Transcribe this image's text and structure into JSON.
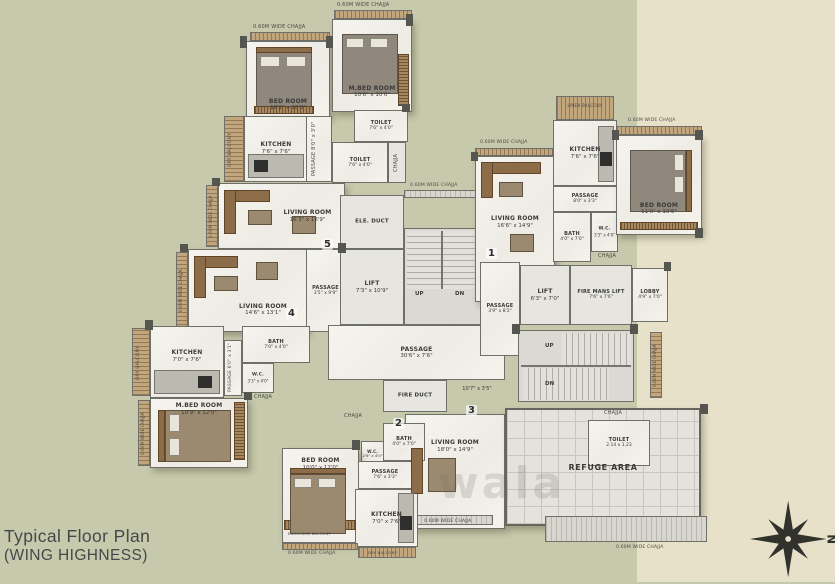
{
  "title": {
    "line1": "Typical Floor Plan",
    "line2": "(WING HIGHNESS)"
  },
  "compass": {
    "label": "N"
  },
  "watermark": "wala",
  "annotations": {
    "chajja_wide": "0.60M WIDE CHAJJA",
    "chajja": "CHAJJA",
    "dry_balcony": "DRY BALCONY",
    "linen_balcony": "LINEN BALCONY",
    "enclosed_balcony": "ENCLOSED BALCONY",
    "up": "UP",
    "dn": "DN"
  },
  "flats": {
    "f1": "1",
    "f2": "2",
    "f3": "3",
    "f4": "4",
    "f5": "5"
  },
  "rooms": {
    "bed6a": {
      "name": "BED ROOM",
      "dims": "10'2\" x 10'0\""
    },
    "mbed6": {
      "name": "M.BED ROOM",
      "dims": "10'6\" x 10'0\""
    },
    "kitchen6": {
      "name": "KITCHEN",
      "dims": "7'6\" x 7'6\""
    },
    "passage6": {
      "name": "PASSAGE",
      "dims": "8'0\" x 3'0\""
    },
    "toilet6a": {
      "name": "TOILET",
      "dims": "7'6\" x 4'0\""
    },
    "toilet6b": {
      "name": "TOILET",
      "dims": "7'6\" x 4'0\""
    },
    "living5": {
      "name": "LIVING ROOM",
      "dims": "16'3\" x 16'9\""
    },
    "living4": {
      "name": "LIVING ROOM",
      "dims": "14'6\" x 13'1\""
    },
    "passage4": {
      "name": "PASSAGE",
      "dims": "3'5\" x 9'9\""
    },
    "bath4": {
      "name": "BATH",
      "dims": "7'0\" x 4'0\""
    },
    "wc4": {
      "name": "W.C.",
      "dims": "3'3\" x 4'0\""
    },
    "kitchen4": {
      "name": "KITCHEN",
      "dims": "7'0\" x 7'6\""
    },
    "passage4b": {
      "name": "PASSAGE",
      "dims": "6'0\" x 3'1\""
    },
    "mbed4": {
      "name": "M.BED ROOM",
      "dims": "10'9\" x 12'0\""
    },
    "ele_duct": {
      "name": "ELE. DUCT",
      "dims": ""
    },
    "lift_a": {
      "name": "LIFT",
      "dims": "7'3\" x 10'9\""
    },
    "passage_main": {
      "name": "PASSAGE",
      "dims": "30'6\" x 7'6\""
    },
    "fire_duct": {
      "name": "FIRE DUCT",
      "dims": ""
    },
    "passage_3": {
      "name": "",
      "dims": "10'7\" x 3'5\""
    },
    "passage_r": {
      "name": "PASSAGE",
      "dims": "3'9\" x 8'2\""
    },
    "lift_b": {
      "name": "LIFT",
      "dims": "6'3\" x 7'0\""
    },
    "fire_lift": {
      "name": "FIRE MANS LIFT",
      "dims": "7'6\" x 7'6\""
    },
    "lobby": {
      "name": "LOBBY",
      "dims": "4'9\" x 7'0\""
    },
    "living1": {
      "name": "LIVING ROOM",
      "dims": "16'6\" x 14'9\""
    },
    "kitchen1": {
      "name": "KITCHEN",
      "dims": "7'6\" x 7'6\""
    },
    "bed1": {
      "name": "BED ROOM",
      "dims": "11'0\" x 10'6\""
    },
    "passage1": {
      "name": "PASSAGE",
      "dims": "8'0\" x 3'3\""
    },
    "bath1": {
      "name": "BATH",
      "dims": "4'0\" x 7'0\""
    },
    "wc1": {
      "name": "W.C.",
      "dims": "3'3\" x 4'0\""
    },
    "living3": {
      "name": "LIVING ROOM",
      "dims": "18'0\" x 14'9\""
    },
    "bath2": {
      "name": "BATH",
      "dims": "4'0\" x 7'0\""
    },
    "wc2": {
      "name": "W.C.",
      "dims": "2'6\" x 4'0\""
    },
    "bed2": {
      "name": "BED ROOM",
      "dims": "10'0\" x 12'0\""
    },
    "passage2": {
      "name": "PASSAGE",
      "dims": "7'6\" x 3'3\""
    },
    "kitchen2": {
      "name": "KITCHEN",
      "dims": "7'0\" x 7'6\""
    },
    "refuge": {
      "name": "REFUGE AREA",
      "dims": ""
    },
    "toilet_refuge": {
      "name": "TOILET",
      "dims": "2.14 x 1.23"
    }
  }
}
